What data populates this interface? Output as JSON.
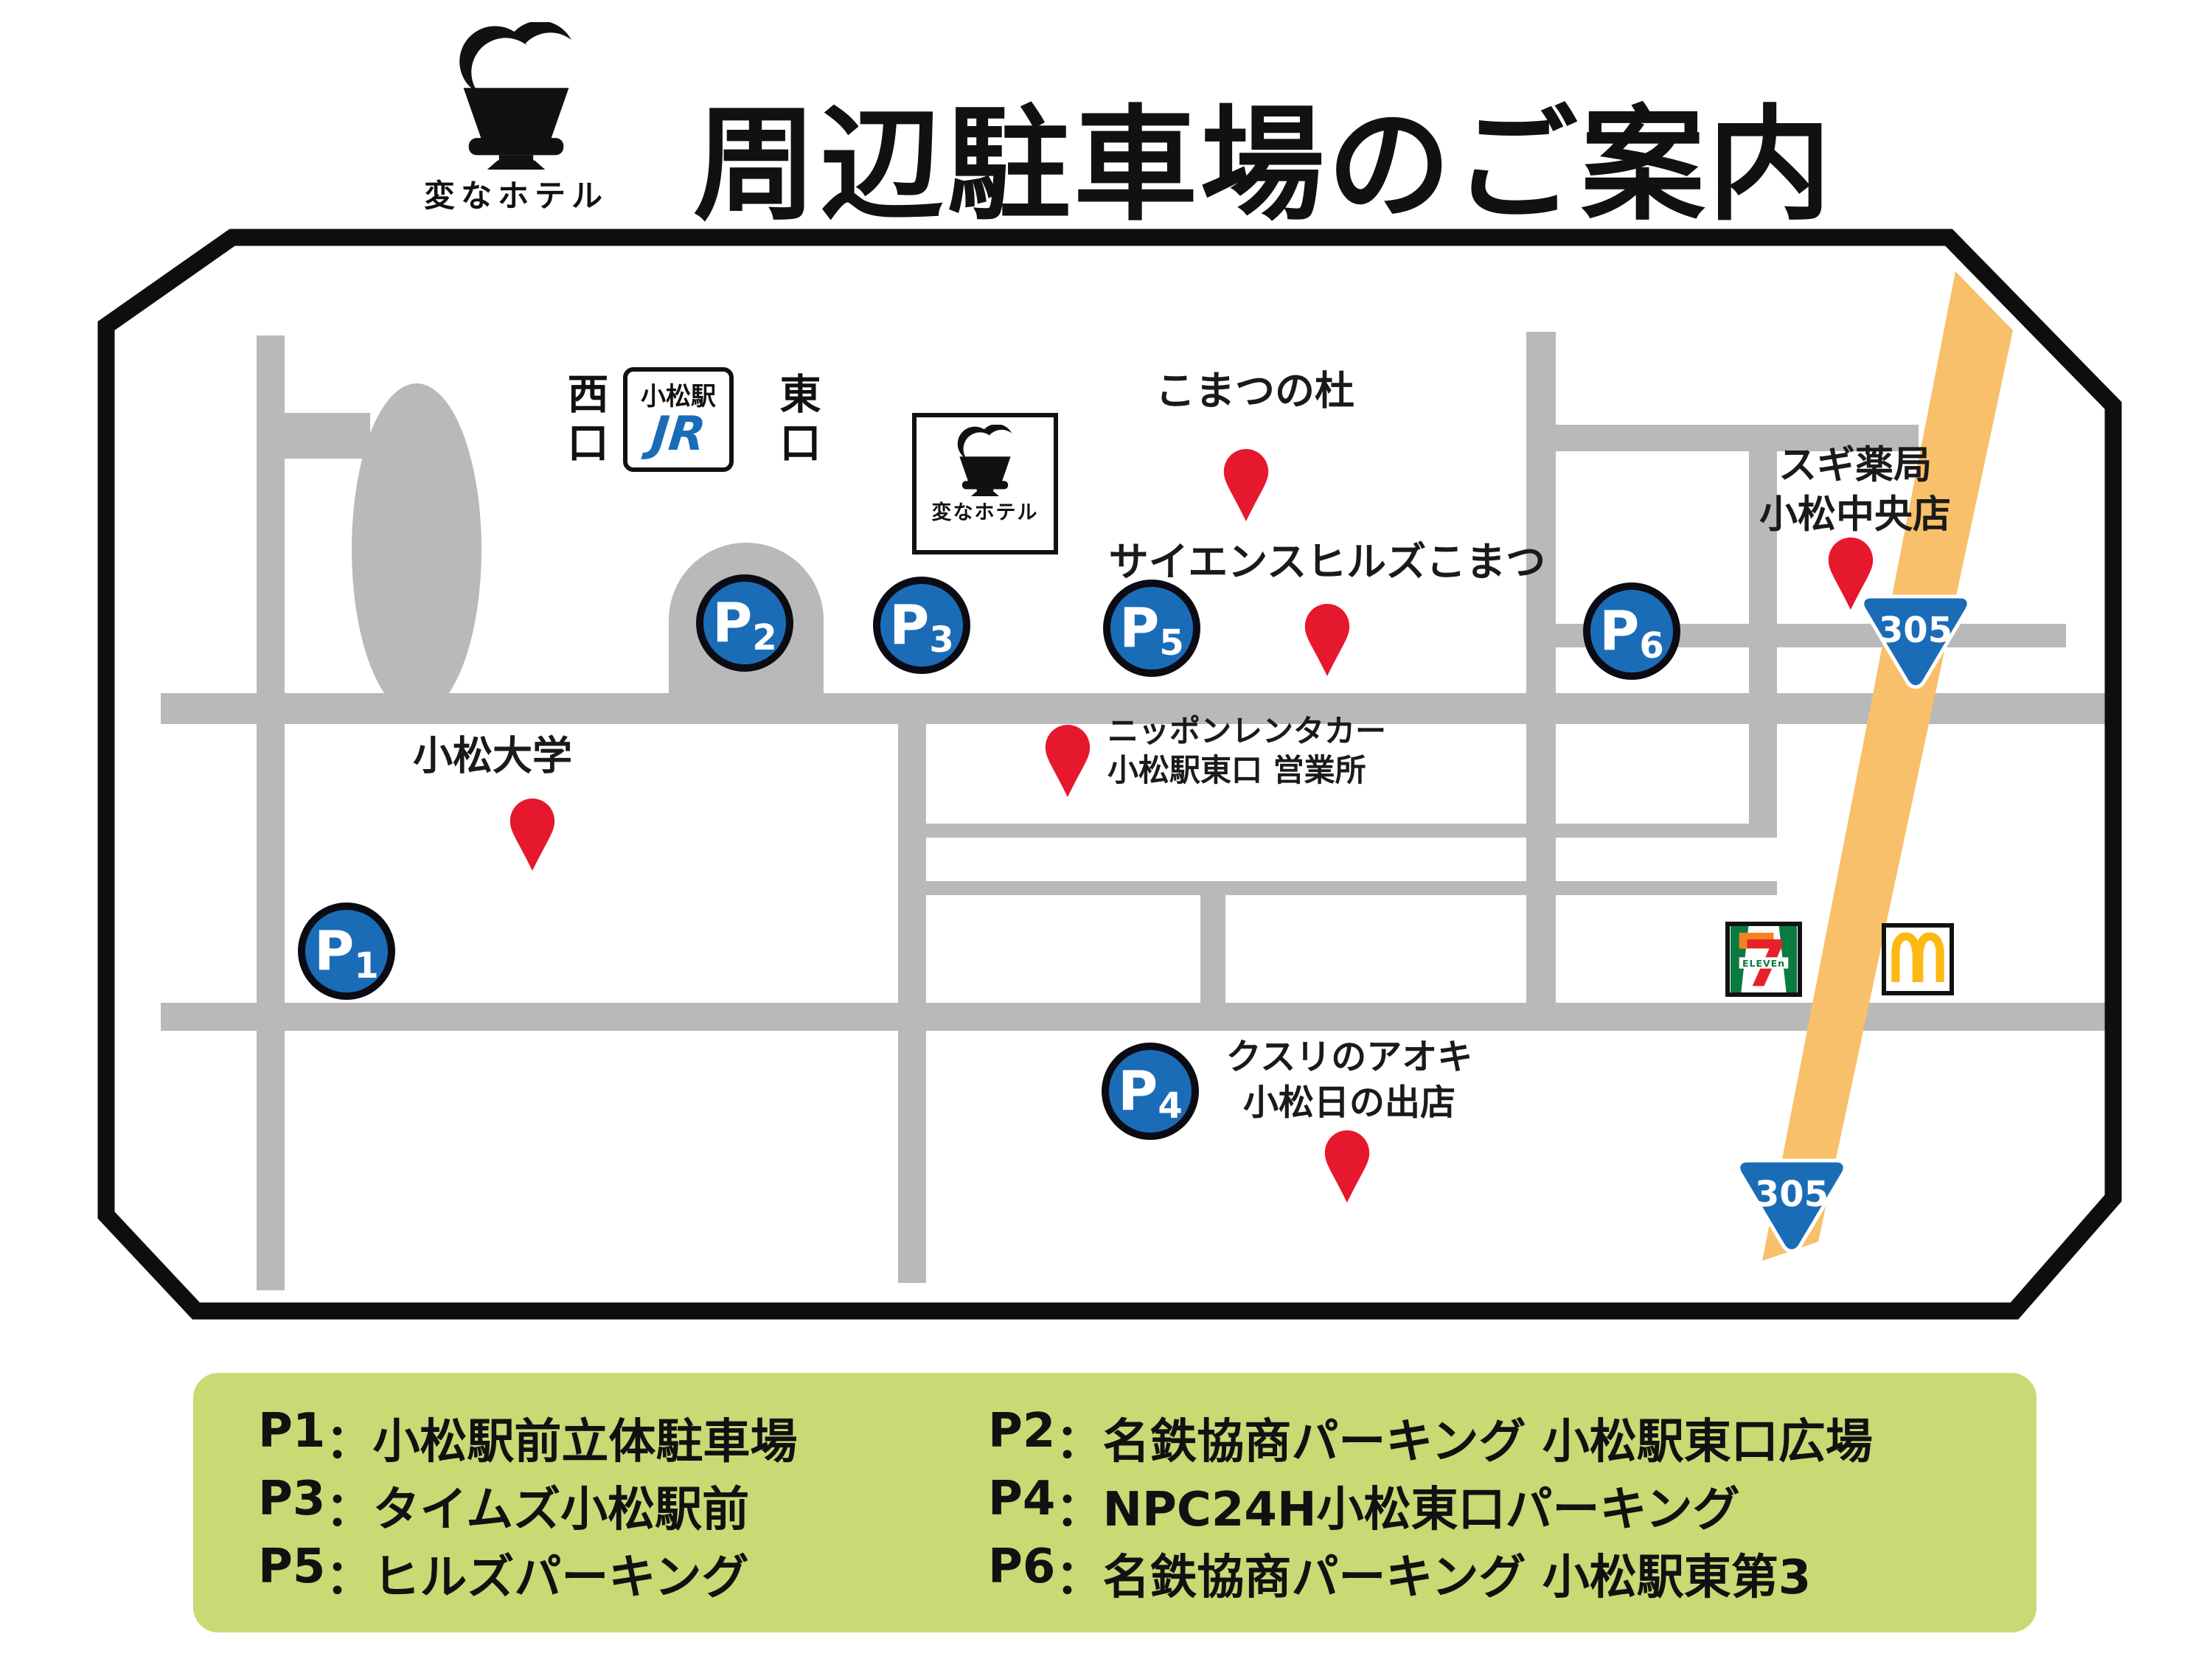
{
  "header": {
    "brand": "変なホテル",
    "title": "周辺駐車場のご案内"
  },
  "map": {
    "station": {
      "west_exit": "西口",
      "name": "小松駅",
      "jr": "JR",
      "east_exit": "東口"
    },
    "hotel": {
      "label": "変なホテル"
    },
    "route_number": "305",
    "parking_letter": "P",
    "parking_numbers": [
      "1",
      "2",
      "3",
      "4",
      "5",
      "6"
    ],
    "pois": {
      "komatsu_no_mori": "こまつの杜",
      "science_hills": "サイエンスヒルズこまつ",
      "sugi_pharmacy_line1": "スギ薬局",
      "sugi_pharmacy_line2": "小松中央店",
      "komatsu_university": "小松大学",
      "rentacar_line1": "ニッポンレンタカー",
      "rentacar_line2": "小松駅東口 営業所",
      "aoki_line1": "クスリのアオキ",
      "aoki_line2": "小松日の出店"
    },
    "stores": {
      "seven": "7",
      "eleven": "ELEVEn"
    }
  },
  "legend": {
    "separator": "：",
    "items": [
      {
        "id": "P1",
        "name": "小松駅前立体駐車場"
      },
      {
        "id": "P2",
        "name": "名鉄協商パーキング 小松駅東口広場"
      },
      {
        "id": "P3",
        "name": "タイムズ小松駅前"
      },
      {
        "id": "P4",
        "name": "NPC24H小松東口パーキング"
      },
      {
        "id": "P5",
        "name": "ヒルズパーキング"
      },
      {
        "id": "P6",
        "name": "名鉄協商パーキング 小松駅東第3"
      }
    ]
  },
  "icons": {
    "brand_logo": "henn-na-hotel-crown",
    "map_marker": "red-map-pin",
    "route_shield": "japan-prefectural-route-305",
    "seven_eleven": "seven-eleven-store",
    "mcdonalds": "mcdonalds-golden-arches"
  },
  "colors": {
    "road_gray": "#b9b9b9",
    "brand_blue": "#1b6cb7",
    "pin_red": "#e6182e",
    "route_orange": "#f8c06a",
    "legend_green": "#c7da74",
    "border_black": "#0e0e0e",
    "seven_green": "#0a7b40",
    "seven_orange": "#f58220",
    "seven_red": "#e62129",
    "mcdonalds_yellow": "#fdb913"
  }
}
